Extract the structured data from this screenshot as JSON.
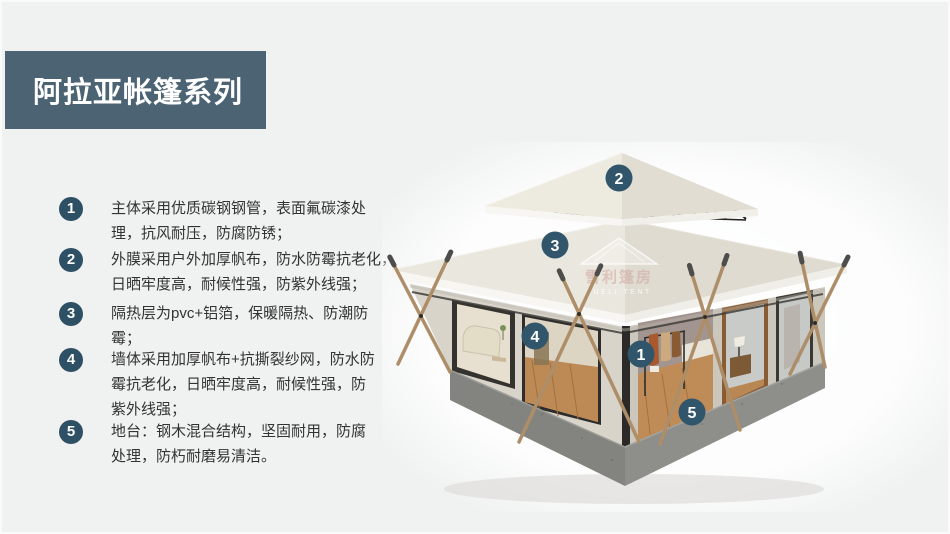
{
  "header": {
    "title": "阿拉亚帐篷系列",
    "bg_color": "#4c6374",
    "text_color": "#ffffff"
  },
  "features": {
    "badge_color": "#2d5065",
    "items": [
      {
        "num": "1",
        "text": "主体采用优质碳钢钢管，表面氟碳漆处\n理，抗风耐压，防腐防锈；"
      },
      {
        "num": "2",
        "text": "外膜采用户外加厚帆布，防水防霉抗老化，\n日晒牢度高，耐候性强，防紫外线强；"
      },
      {
        "num": "3",
        "text": "隔热层为pvc+铝箔，保暖隔热、防潮防\n霉；"
      },
      {
        "num": "4",
        "text": "墙体采用加厚帆布+抗撕裂纱网，防水防\n霉抗老化，日晒牢度高，耐候性强，防\n紫外线强；"
      },
      {
        "num": "5",
        "text": "地台：钢木混合结构，坚固耐用，防腐\n处理，防朽耐磨易清洁。"
      }
    ]
  },
  "illustration": {
    "type": "two-tier pagoda glamping tent, 3D render with numbered part callouts",
    "marker_color": "#31566b",
    "canvas_color": "#e8e5dd",
    "base_color": "#83847f",
    "pole_color": "#ad8e68",
    "markers": [
      {
        "label": "1"
      },
      {
        "label": "2"
      },
      {
        "label": "3"
      },
      {
        "label": "4"
      },
      {
        "label": "5"
      }
    ],
    "watermark": {
      "cn": "雪利篷房",
      "en": "XUELI TENT"
    }
  }
}
